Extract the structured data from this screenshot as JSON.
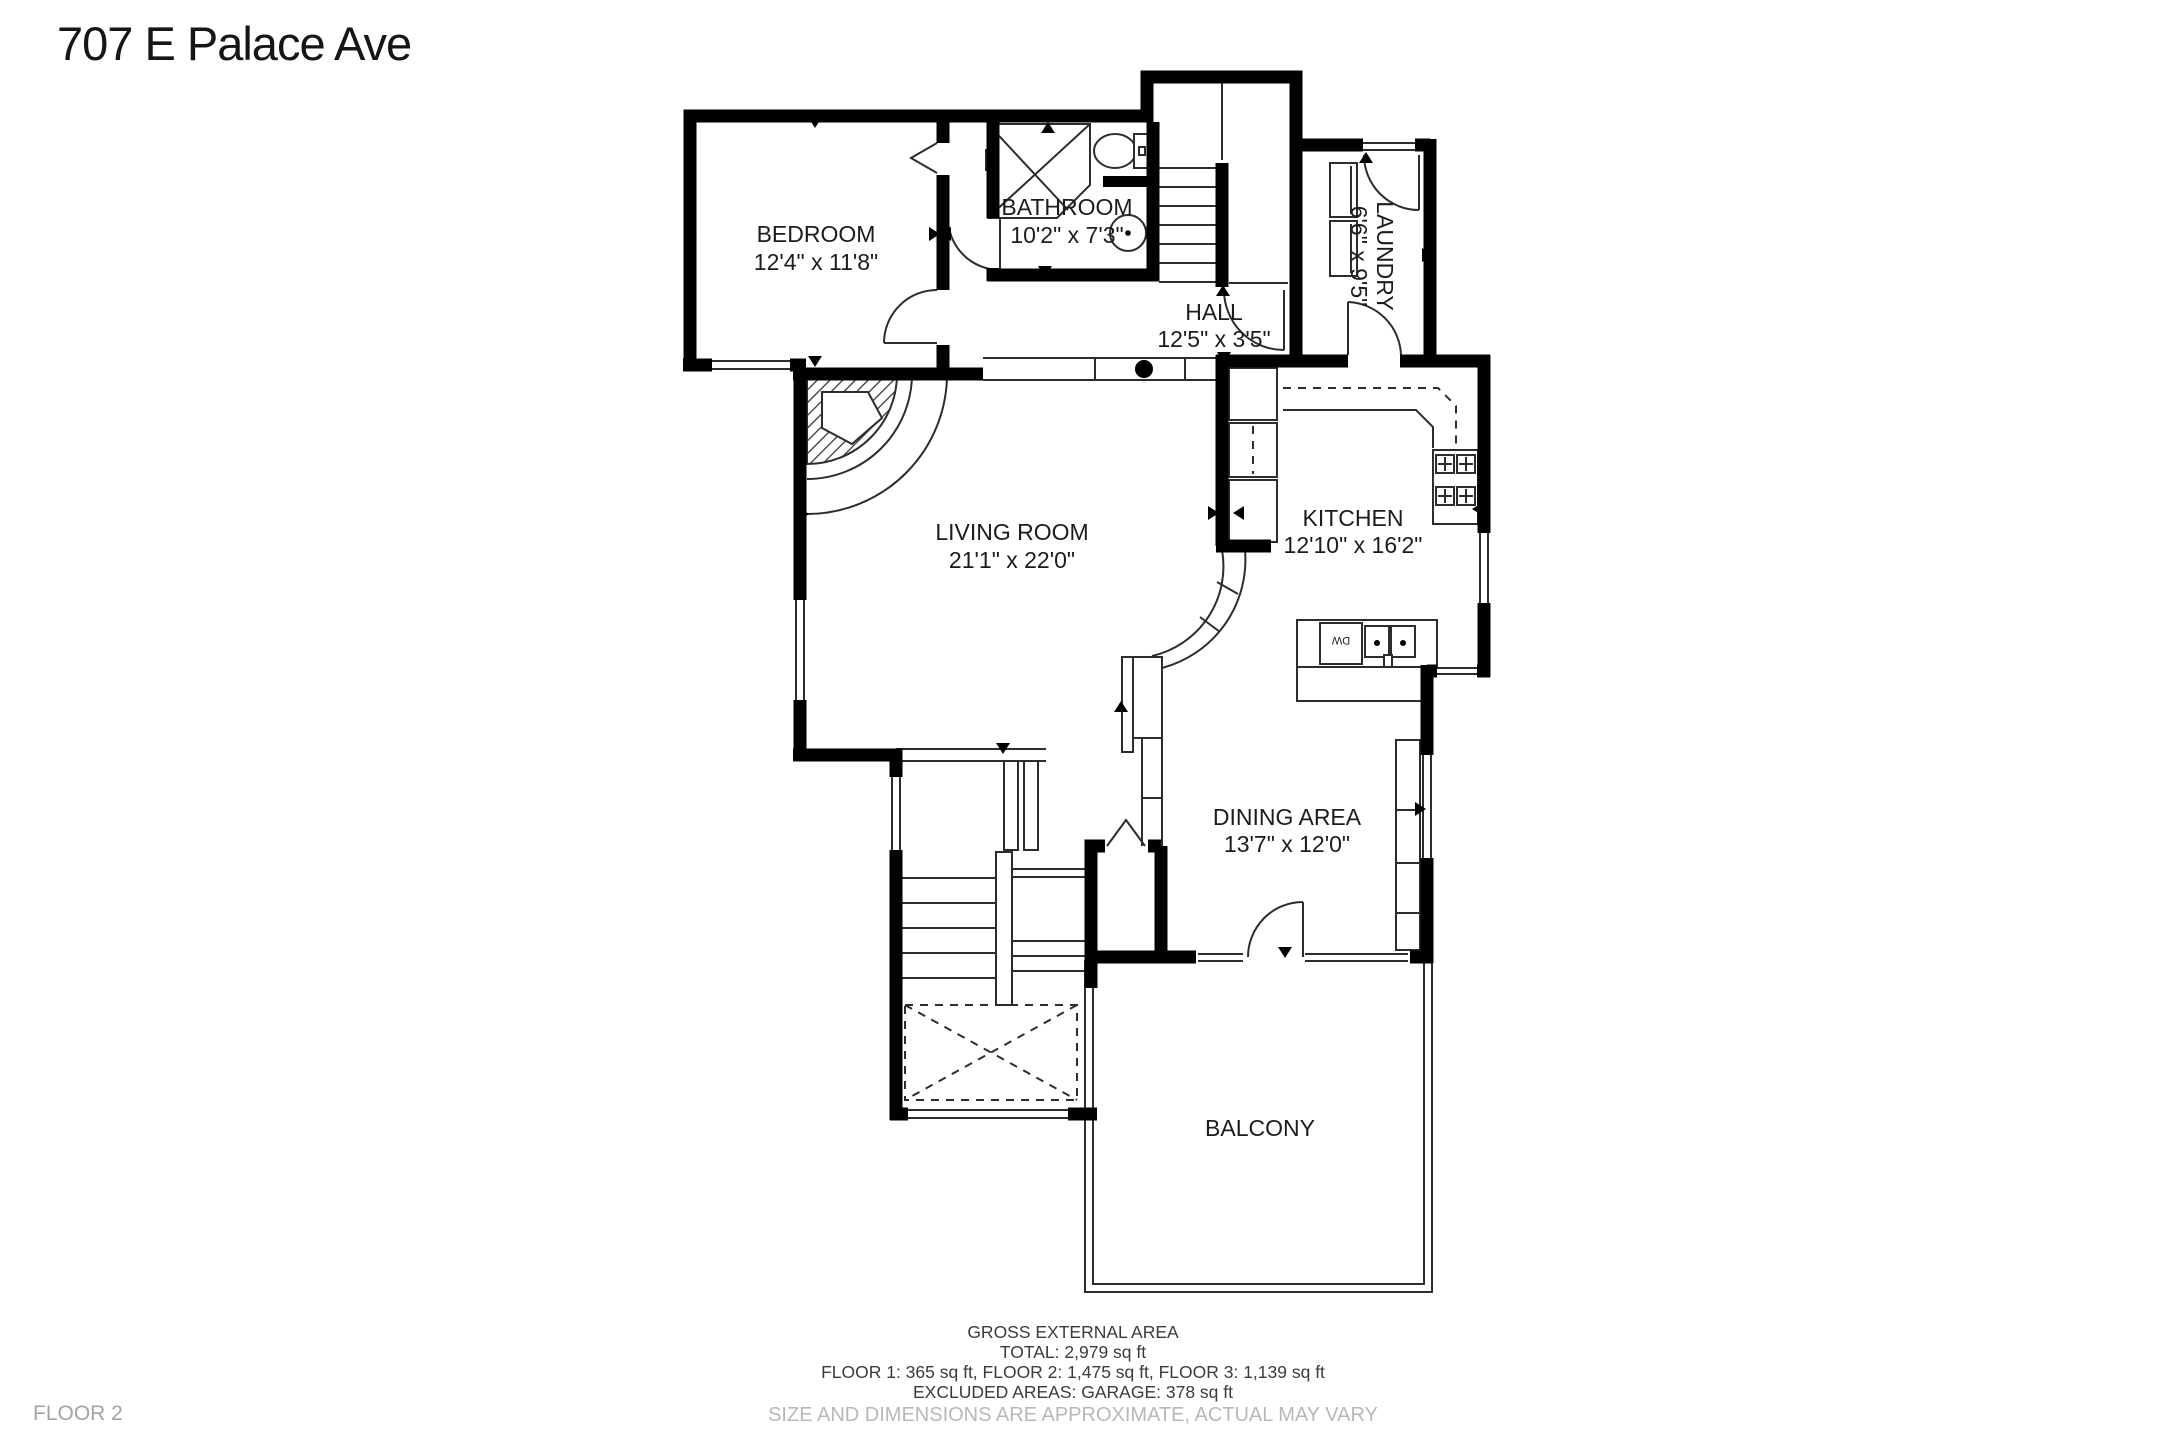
{
  "title": "707 E Palace Ave",
  "floor_label": "FLOOR 2",
  "rooms": [
    {
      "name": "BEDROOM",
      "dims": "12'4\" x 11'8\""
    },
    {
      "name": "BATHROOM",
      "dims": "10'2\" x 7'3\""
    },
    {
      "name": "HALL",
      "dims": "12'5\" x 3'5\""
    },
    {
      "name": "LAUNDRY",
      "dims": "6'6\" x 9'5\""
    },
    {
      "name": "LIVING ROOM",
      "dims": "21'1\" x 22'0\""
    },
    {
      "name": "KITCHEN",
      "dims": "12'10\" x 16'2\""
    },
    {
      "name": "DINING AREA",
      "dims": "13'7\" x 12'0\""
    },
    {
      "name": "BALCONY",
      "dims": ""
    }
  ],
  "fixtures": {
    "dishwasher_label": "DW"
  },
  "footer": {
    "line1": "GROSS EXTERNAL AREA",
    "line2": "TOTAL: 2,979 sq ft",
    "line3": "FLOOR 1: 365 sq ft, FLOOR 2: 1,475 sq ft, FLOOR 3: 1,139 sq ft",
    "line4": "EXCLUDED AREAS: GARAGE: 378 sq ft",
    "line5": "SIZE AND DIMENSIONS ARE APPROXIMATE, ACTUAL MAY VARY"
  },
  "colors": {
    "wall": "#000000",
    "thin_line": "#2d2d2d",
    "muted_text": "#b8b8b8",
    "text": "#1c1c1c"
  }
}
